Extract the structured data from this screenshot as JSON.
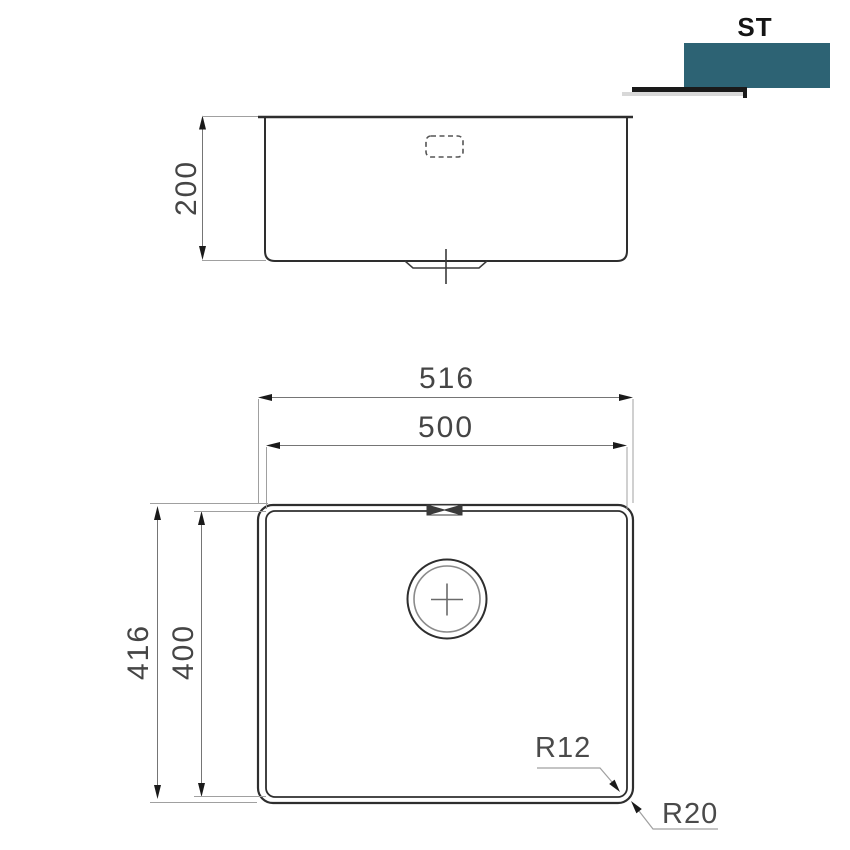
{
  "page": {
    "background_color": "#ffffff"
  },
  "logo": {
    "text": "ST",
    "accent_color": "#2d6374",
    "underline_color": "#1a1a1a"
  },
  "front_view": {
    "depth": "200"
  },
  "plan_view": {
    "overall_width": "516",
    "bowl_width": "500",
    "overall_depth": "416",
    "bowl_depth": "400",
    "inner_corner_radius": "R12",
    "outer_corner_radius": "R20"
  }
}
